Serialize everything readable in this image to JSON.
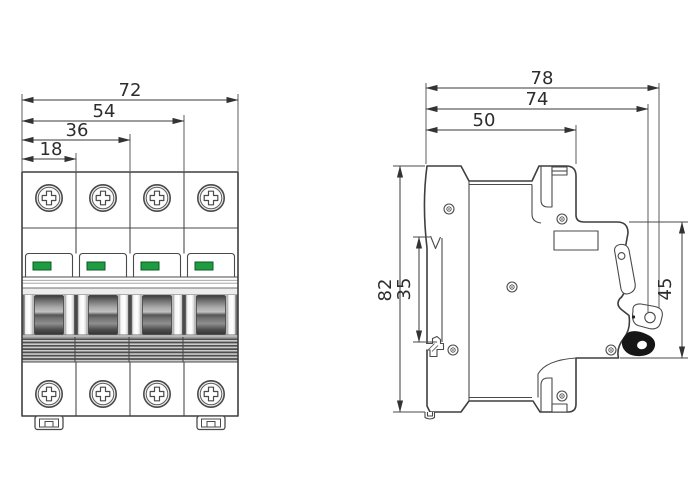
{
  "colors": {
    "background": "#ffffff",
    "line": "#3f3f3f",
    "dim_line": "#3a3a3a",
    "text": "#2d2d2d",
    "indicator_green": "#1f9c41",
    "indicator_green_border": "#0d5a23",
    "handle_dark": "#3c3c3c",
    "stripe_base": "#cbcbcb"
  },
  "front_view": {
    "dim_labels": {
      "overall_width": "72",
      "width_3_modules": "54",
      "width_2_modules": "36",
      "width_1_module": "18"
    }
  },
  "side_view": {
    "dim_labels": {
      "overall_depth": "78",
      "depth_with_handle": "74",
      "body_depth": "50",
      "overall_height": "82",
      "din_recess_height": "35",
      "front_section_height": "45"
    }
  }
}
